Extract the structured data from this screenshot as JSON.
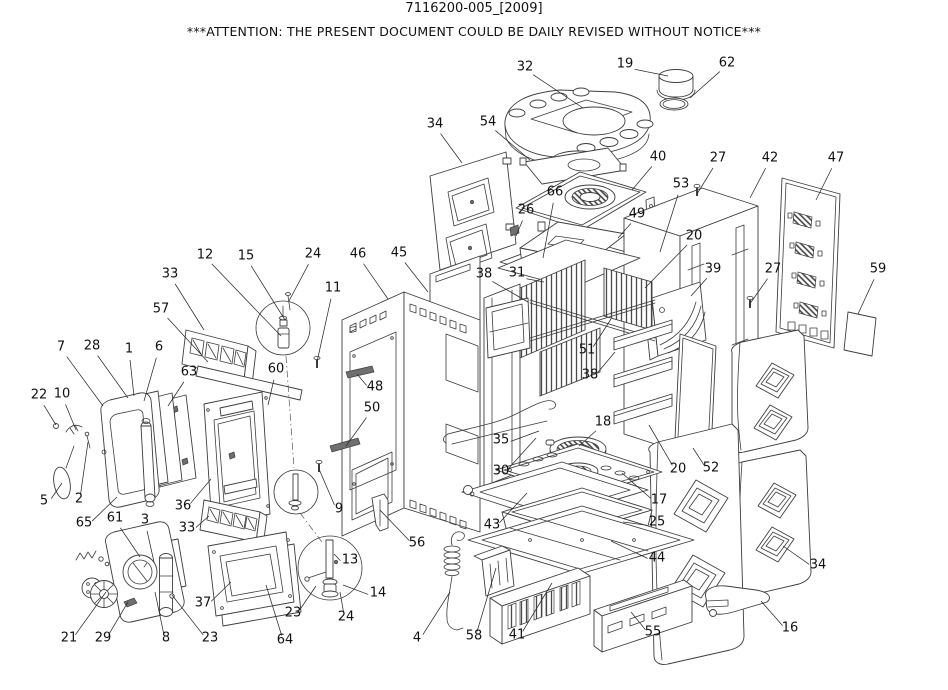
{
  "title": "7116200-005_[2009]",
  "notice": "***ATTENTION: THE PRESENT DOCUMENT COULD BE DAILY REVISED WITHOUT NOTICE***",
  "diagram": {
    "kind": "exploded-parts-diagram",
    "labels": [
      {
        "part": "32",
        "x": 525,
        "y": 66,
        "lx": 583,
        "ly": 108
      },
      {
        "part": "19",
        "x": 625,
        "y": 63,
        "lx": 668,
        "ly": 76
      },
      {
        "part": "62",
        "x": 727,
        "y": 62,
        "lx": 690,
        "ly": 98
      },
      {
        "part": "34",
        "x": 435,
        "y": 123,
        "lx": 462,
        "ly": 163
      },
      {
        "part": "54",
        "x": 488,
        "y": 121,
        "lx": 530,
        "ly": 160
      },
      {
        "part": "40",
        "x": 658,
        "y": 156,
        "lx": 632,
        "ly": 190
      },
      {
        "part": "27",
        "x": 718,
        "y": 157,
        "lx": 697,
        "ly": 194
      },
      {
        "part": "42",
        "x": 770,
        "y": 157,
        "lx": 750,
        "ly": 198
      },
      {
        "part": "47",
        "x": 836,
        "y": 157,
        "lx": 816,
        "ly": 200
      },
      {
        "part": "66",
        "x": 555,
        "y": 191,
        "lx": 543,
        "ly": 258
      },
      {
        "part": "26",
        "x": 526,
        "y": 209,
        "lx": 516,
        "ly": 236
      },
      {
        "part": "53",
        "x": 681,
        "y": 183,
        "lx": 660,
        "ly": 252
      },
      {
        "part": "49",
        "x": 637,
        "y": 213,
        "lx": 618,
        "ly": 238
      },
      {
        "part": "20",
        "x": 694,
        "y": 235,
        "lx": 645,
        "ly": 288
      },
      {
        "part": "39",
        "x": 713,
        "y": 268,
        "lx": 691,
        "ly": 296
      },
      {
        "part": "27",
        "x": 773,
        "y": 268,
        "lx": 749,
        "ly": 305
      },
      {
        "part": "59",
        "x": 878,
        "y": 268,
        "lx": 858,
        "ly": 314
      },
      {
        "part": "12",
        "x": 205,
        "y": 254,
        "lx": 281,
        "ly": 336
      },
      {
        "part": "15",
        "x": 246,
        "y": 255,
        "lx": 285,
        "ly": 320
      },
      {
        "part": "24",
        "x": 313,
        "y": 253,
        "lx": 289,
        "ly": 301
      },
      {
        "part": "11",
        "x": 333,
        "y": 287,
        "lx": 317,
        "ly": 362
      },
      {
        "part": "46",
        "x": 358,
        "y": 253,
        "lx": 388,
        "ly": 299
      },
      {
        "part": "45",
        "x": 399,
        "y": 252,
        "lx": 428,
        "ly": 292
      },
      {
        "part": "33",
        "x": 170,
        "y": 273,
        "lx": 204,
        "ly": 330
      },
      {
        "part": "57",
        "x": 161,
        "y": 308,
        "lx": 208,
        "ly": 362
      },
      {
        "part": "7",
        "x": 61,
        "y": 346,
        "lx": 103,
        "ly": 406
      },
      {
        "part": "28",
        "x": 92,
        "y": 345,
        "lx": 128,
        "ly": 398
      },
      {
        "part": "1",
        "x": 129,
        "y": 348,
        "lx": 134,
        "ly": 396
      },
      {
        "part": "6",
        "x": 159,
        "y": 346,
        "lx": 144,
        "ly": 401
      },
      {
        "part": "63",
        "x": 189,
        "y": 371,
        "lx": 168,
        "ly": 406
      },
      {
        "part": "60",
        "x": 276,
        "y": 368,
        "lx": 268,
        "ly": 405
      },
      {
        "part": "48",
        "x": 375,
        "y": 386,
        "lx": 357,
        "ly": 374
      },
      {
        "part": "50",
        "x": 372,
        "y": 407,
        "lx": 346,
        "ly": 446
      },
      {
        "part": "22",
        "x": 39,
        "y": 394,
        "lx": 56,
        "ly": 425
      },
      {
        "part": "10",
        "x": 62,
        "y": 393,
        "lx": 76,
        "ly": 430
      },
      {
        "part": "5",
        "x": 44,
        "y": 500,
        "lx": 62,
        "ly": 483
      },
      {
        "part": "2",
        "x": 79,
        "y": 498,
        "lx": 88,
        "ly": 442
      },
      {
        "part": "65",
        "x": 84,
        "y": 522,
        "lx": 117,
        "ly": 497
      },
      {
        "part": "61",
        "x": 115,
        "y": 517,
        "lx": 140,
        "ly": 557
      },
      {
        "part": "3",
        "x": 145,
        "y": 519,
        "lx": 154,
        "ly": 562
      },
      {
        "part": "36",
        "x": 183,
        "y": 505,
        "lx": 211,
        "ly": 479
      },
      {
        "part": "33",
        "x": 187,
        "y": 527,
        "lx": 209,
        "ly": 516
      },
      {
        "part": "21",
        "x": 69,
        "y": 637,
        "lx": 106,
        "ly": 592
      },
      {
        "part": "29",
        "x": 103,
        "y": 637,
        "lx": 128,
        "ly": 602
      },
      {
        "part": "8",
        "x": 166,
        "y": 637,
        "lx": 155,
        "ly": 592
      },
      {
        "part": "23",
        "x": 210,
        "y": 637,
        "lx": 172,
        "ly": 595
      },
      {
        "part": "37",
        "x": 203,
        "y": 602,
        "lx": 231,
        "ly": 582
      },
      {
        "part": "64",
        "x": 285,
        "y": 639,
        "lx": 266,
        "ly": 585
      },
      {
        "part": "23",
        "x": 293,
        "y": 612,
        "lx": 316,
        "ly": 586
      },
      {
        "part": "24",
        "x": 346,
        "y": 616,
        "lx": 340,
        "ly": 592
      },
      {
        "part": "13",
        "x": 350,
        "y": 559,
        "lx": 334,
        "ly": 554
      },
      {
        "part": "14",
        "x": 378,
        "y": 592,
        "lx": 343,
        "ly": 585
      },
      {
        "part": "9",
        "x": 339,
        "y": 508,
        "lx": 319,
        "ly": 469
      },
      {
        "part": "56",
        "x": 417,
        "y": 542,
        "lx": 380,
        "ly": 510
      },
      {
        "part": "4",
        "x": 417,
        "y": 637,
        "lx": 450,
        "ly": 592
      },
      {
        "part": "58",
        "x": 474,
        "y": 635,
        "lx": 496,
        "ly": 568
      },
      {
        "part": "41",
        "x": 517,
        "y": 634,
        "lx": 552,
        "ly": 583
      },
      {
        "part": "55",
        "x": 653,
        "y": 631,
        "lx": 631,
        "ly": 612
      },
      {
        "part": "44",
        "x": 657,
        "y": 557,
        "lx": 611,
        "ly": 541
      },
      {
        "part": "43",
        "x": 492,
        "y": 524,
        "lx": 527,
        "ly": 493
      },
      {
        "part": "25",
        "x": 657,
        "y": 521,
        "lx": 623,
        "ly": 522
      },
      {
        "part": "17",
        "x": 659,
        "y": 499,
        "lx": 622,
        "ly": 473
      },
      {
        "part": "18",
        "x": 603,
        "y": 421,
        "lx": 579,
        "ly": 446
      },
      {
        "part": "35",
        "x": 501,
        "y": 439,
        "lx": 539,
        "ly": 431
      },
      {
        "part": "30",
        "x": 501,
        "y": 470,
        "lx": 536,
        "ly": 438
      },
      {
        "part": "20",
        "x": 678,
        "y": 468,
        "lx": 649,
        "ly": 425
      },
      {
        "part": "52",
        "x": 711,
        "y": 467,
        "lx": 693,
        "ly": 448
      },
      {
        "part": "51",
        "x": 587,
        "y": 349,
        "lx": 611,
        "ly": 319
      },
      {
        "part": "38",
        "x": 590,
        "y": 374,
        "lx": 615,
        "ly": 352
      },
      {
        "part": "31",
        "x": 517,
        "y": 272,
        "lx": 544,
        "ly": 282
      },
      {
        "part": "38",
        "x": 484,
        "y": 273,
        "lx": 528,
        "ly": 302
      },
      {
        "part": "34",
        "x": 818,
        "y": 564,
        "lx": 783,
        "ly": 546
      },
      {
        "part": "16",
        "x": 790,
        "y": 627,
        "lx": 761,
        "ly": 601
      }
    ]
  }
}
